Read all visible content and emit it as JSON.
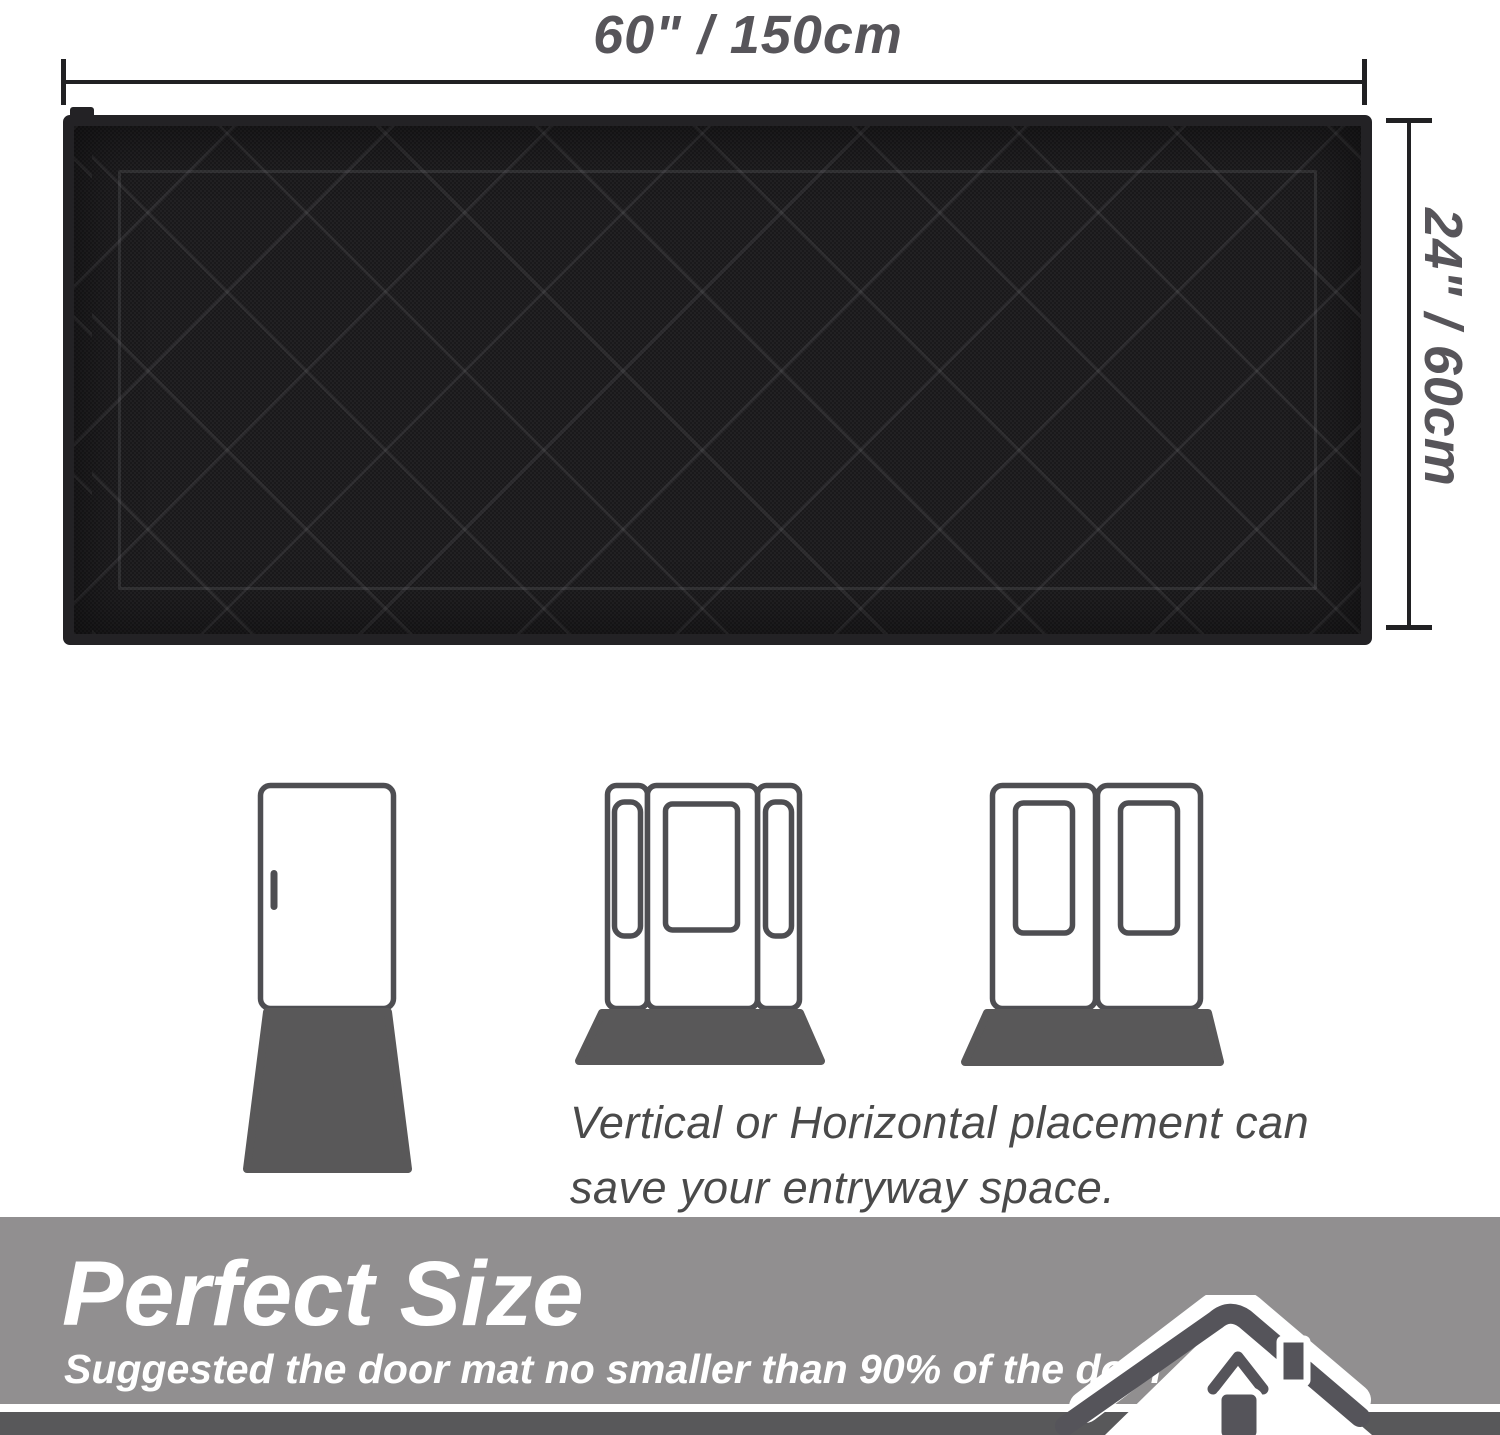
{
  "dimensions": {
    "width_label": "60\" / 150cm",
    "height_label": "24\" / 60cm"
  },
  "placement": {
    "caption_line1": "Vertical or Horizontal placement can",
    "caption_line2": "save your entryway space."
  },
  "banner": {
    "title": "Perfect Size",
    "subtitle": "Suggested the door mat no smaller than 90% of the door width."
  },
  "icons": {
    "single_door": "single-door-with-vertical-mat",
    "sidelight_door": "door-with-sidelights-and-horizontal-mat",
    "double_door": "double-door-with-horizontal-mat",
    "house": "house-roofline"
  },
  "colors": {
    "mat_black": "#1a191b",
    "mat_binding": "#232225",
    "dimension_line": "#212123",
    "dimension_text": "#57555a",
    "door_outline": "#4e4e52",
    "door_mat_gray": "#595859",
    "caption_text": "#4a4a4a",
    "banner_bg": "#918f90",
    "banner_text": "#ffffff",
    "footer_strip": "#58585a",
    "house_icon": "#55545a"
  }
}
